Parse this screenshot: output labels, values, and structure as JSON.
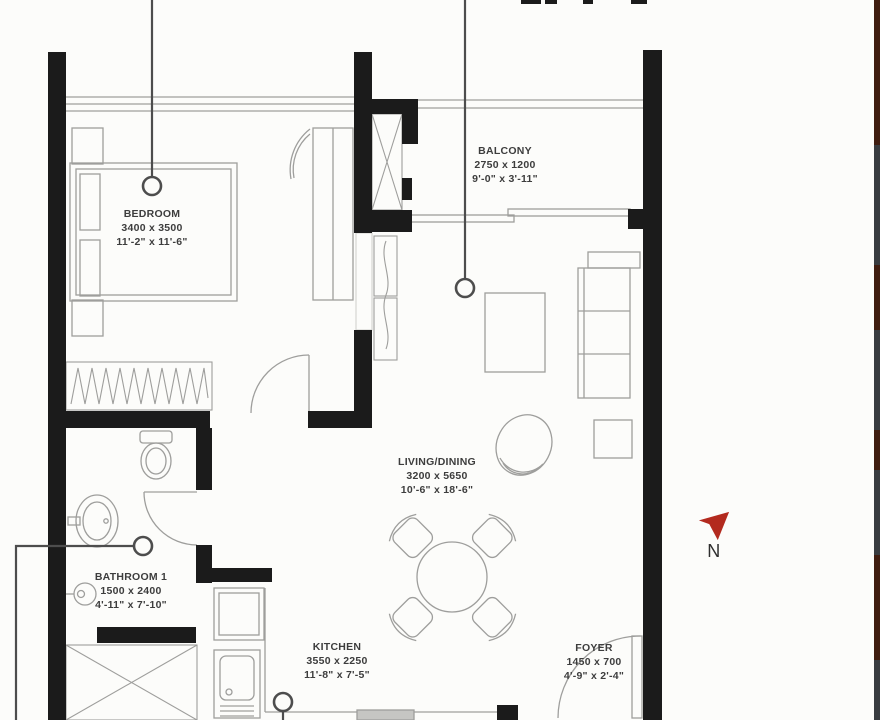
{
  "plan": {
    "type": "apartment-floor-plan",
    "north_label": "N"
  },
  "colors": {
    "wall": "#1b1b1b",
    "furniture_line": "#9e9e9c",
    "leader": "#4d4d4d",
    "text": "#3d3d3d",
    "north_arrow": "#b32a1e",
    "paper": "#fcfcfa"
  },
  "rooms": [
    {
      "id": "bedroom",
      "name": "BEDROOM",
      "size_mm": "3400 x 3500",
      "size_ft": "11'-2\" x 11'-6\""
    },
    {
      "id": "balcony",
      "name": "BALCONY",
      "size_mm": "2750 x 1200",
      "size_ft": "9'-0\" x 3'-11\""
    },
    {
      "id": "living",
      "name": "LIVING/DINING",
      "size_mm": "3200 x 5650",
      "size_ft": "10'-6\" x 18'-6\""
    },
    {
      "id": "bathroom",
      "name": "BATHROOM 1",
      "size_mm": "1500 x 2400",
      "size_ft": "4'-11\" x 7'-10\""
    },
    {
      "id": "kitchen",
      "name": "KITCHEN",
      "size_mm": "3550 x 2250",
      "size_ft": "11'-8\" x 7'-5\""
    },
    {
      "id": "foyer",
      "name": "FOYER",
      "size_mm": "1450 x 700",
      "size_ft": "4'-9\" x 2'-4\""
    }
  ]
}
